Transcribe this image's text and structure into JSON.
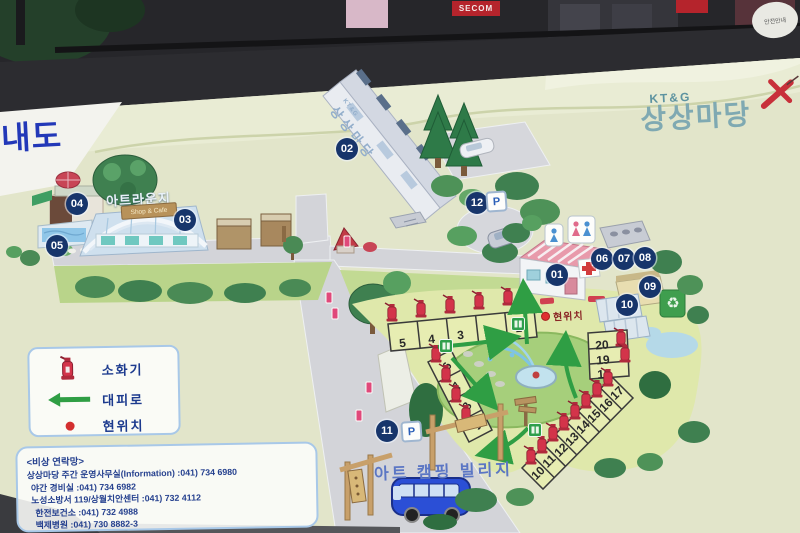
{
  "photo": {
    "oval_sign": "안전안내",
    "red_sign": "SECOM"
  },
  "board": {
    "title_partial": "내도"
  },
  "logo": {
    "brand": "KT&G",
    "name": "상상마당"
  },
  "building02": {
    "brand": "KT&G",
    "wall_text": "상상마당"
  },
  "left_complex": {
    "lounge": "아트라운지",
    "shop_sign": "Shop & Cafe"
  },
  "camping": {
    "village": "아트 캠핑 빌리지"
  },
  "map": {
    "current_location": "현위치",
    "parking": "P",
    "recycle_icon": "♻"
  },
  "markers": [
    "01",
    "02",
    "03",
    "04",
    "05",
    "06",
    "07",
    "08",
    "09",
    "10",
    "11",
    "12"
  ],
  "sites": {
    "top_row": [
      "5",
      "4",
      "3",
      "2",
      "1"
    ],
    "left_col": [
      "6",
      "7",
      "8",
      "9"
    ],
    "right_diag": [
      "10",
      "11",
      "12",
      "13",
      "14",
      "15",
      "16",
      "17"
    ],
    "right_stack": [
      "20",
      "19",
      "18"
    ]
  },
  "legend": {
    "extinguisher": "소화기",
    "evacuation": "대피로",
    "location": "현위치"
  },
  "contact": {
    "title": "<비상 연락망>",
    "lines": [
      "상상마당 주간 운영사무실(Information) :041) 734 6980",
      "야간 경비실 :041) 734 6982",
      "노성소방서 119/상월치안센터 :041) 732 4112",
      "한전보건소 :041) 732 4988",
      "백제병원 :041) 730 8882-3"
    ]
  },
  "colors": {
    "board": "#e2e5ca",
    "marker": "#17356b",
    "route": "#2f9e44",
    "accent_red": "#d3344a",
    "logo_teal": "#7fa9b2",
    "text_navy": "#1c3a8e"
  }
}
